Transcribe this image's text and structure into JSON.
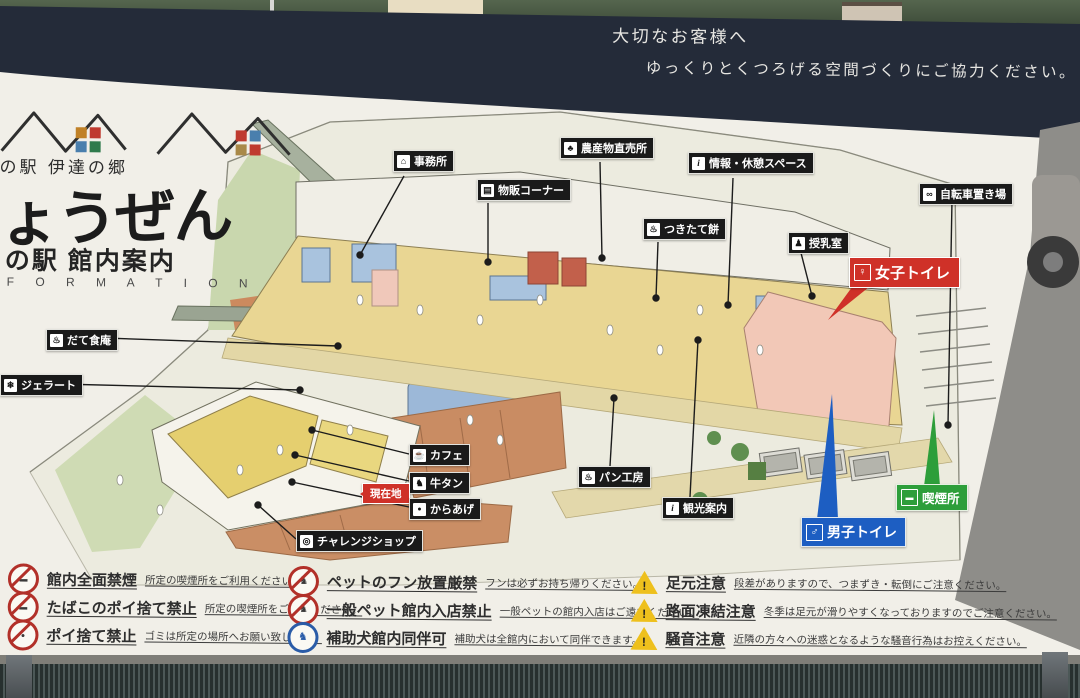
{
  "notice": {
    "line1": "大切なお客様へ",
    "line2": "ゆっくりとくつろげる空間づくりにご協力ください。"
  },
  "logo": {
    "region_script": "の駅 伊達の郷",
    "station_name": "ょうぜん",
    "guide_title": "の駅 館内案内",
    "guide_subtitle": "F O R M A T I O N"
  },
  "map": {
    "labels": [
      {
        "text": "事務所",
        "icon": "office-icon",
        "color": "black"
      },
      {
        "text": "物販コーナー",
        "icon": "shopping-icon",
        "color": "black"
      },
      {
        "text": "農産物直売所",
        "icon": "produce-icon",
        "color": "black"
      },
      {
        "text": "情報・休憩スペース",
        "icon": "info-icon",
        "color": "black"
      },
      {
        "text": "つきたて餅",
        "icon": "mochi-icon",
        "color": "black"
      },
      {
        "text": "授乳室",
        "icon": "nursing-icon",
        "color": "black"
      },
      {
        "text": "自転車置き場",
        "icon": "bicycle-icon",
        "color": "black"
      },
      {
        "text": "女子トイレ",
        "icon": "female-icon",
        "color": "#cf3128"
      },
      {
        "text": "だて食庵",
        "icon": "restaurant-icon",
        "color": "black"
      },
      {
        "text": "ジェラート",
        "icon": "gelato-icon",
        "color": "black"
      },
      {
        "text": "カフェ",
        "icon": "cafe-icon",
        "color": "black"
      },
      {
        "text": "牛タン",
        "icon": "beef-icon",
        "color": "black"
      },
      {
        "text": "現在地",
        "icon": "location-arrow",
        "color": "#cf3128"
      },
      {
        "text": "からあげ",
        "icon": "karaage-icon",
        "color": "black"
      },
      {
        "text": "チャレンジショップ",
        "icon": "shop-icon",
        "color": "black"
      },
      {
        "text": "パン工房",
        "icon": "bread-icon",
        "color": "black"
      },
      {
        "text": "観光案内",
        "icon": "tourist-info-icon",
        "color": "black"
      },
      {
        "text": "男子トイレ",
        "icon": "male-icon",
        "color": "#1d5ec2"
      },
      {
        "text": "喫煙所",
        "icon": "smoking-icon",
        "color": "#2d9e3a"
      }
    ]
  },
  "rules": {
    "items": [
      {
        "title": "館内全面禁煙",
        "note": "所定の喫煙所をご利用ください。",
        "icon": "no-smoking"
      },
      {
        "title": "たばこのポイ捨て禁止",
        "note": "所定の喫煙所をご利用ください。",
        "icon": "no-cigarette-litter"
      },
      {
        "title": "ポイ捨て禁止",
        "note": "ゴミは所定の場所へお願い致します。",
        "icon": "no-littering"
      },
      {
        "title": "ペットのフン放置厳禁",
        "note": "フンは必ずお持ち帰りください。",
        "icon": "no-pet-waste"
      },
      {
        "title": "一般ペット館内入店禁止",
        "note": "一般ペットの館内入店はご遠慮ください。",
        "icon": "no-pets"
      },
      {
        "title": "補助犬館内同伴可",
        "note": "補助犬は全館内において同伴できます。",
        "icon": "assistance-dog-ok"
      },
      {
        "title": "足元注意",
        "note": "段差がありますので、つまずき・転倒にご注意ください。",
        "icon": "caution-step"
      },
      {
        "title": "路面凍結注意",
        "note": "冬季は足元が滑りやすくなっておりますのでご注意ください。",
        "icon": "caution-ice"
      },
      {
        "title": "騒音注意",
        "note": "近隣の方々への迷惑となるような騒音行為はお控えください。",
        "icon": "caution-noise"
      }
    ]
  },
  "colors": {
    "board_navy": "#242b39",
    "panel": "#f1efe8",
    "label_red": "#cf3128",
    "label_blue": "#1d5ec2",
    "label_green": "#2d9e3a",
    "warning_yellow": "#eec01d",
    "prohibit_red": "#b23029"
  }
}
